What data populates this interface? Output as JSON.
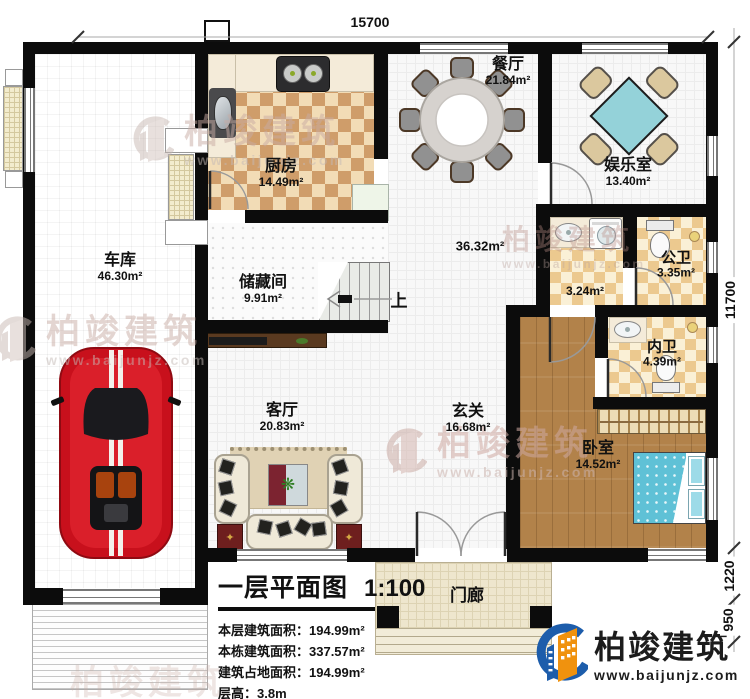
{
  "plan": {
    "dimensions": {
      "top": "15700",
      "right": [
        "11700",
        "1220",
        "950"
      ]
    },
    "stairs": {
      "up_label": "上"
    },
    "rooms": [
      {
        "name": "车库",
        "area": "46.30m²"
      },
      {
        "name": "厨房",
        "area": "14.49m²"
      },
      {
        "name": "餐厅",
        "area": "21.84m²"
      },
      {
        "name": "娱乐室",
        "area": "13.40m²"
      },
      {
        "name": "储藏间",
        "area": "9.91m²"
      },
      {
        "area": "36.32m²"
      },
      {
        "area": "3.24m²"
      },
      {
        "name": "公卫",
        "area": "3.35m²"
      },
      {
        "name": "内卫",
        "area": "4.39m²"
      },
      {
        "name": "玄关",
        "area": "16.68m²"
      },
      {
        "name": "卧室",
        "area": "14.52m²"
      },
      {
        "name": "客厅",
        "area": "20.83m²"
      },
      {
        "name": "门廊"
      }
    ],
    "title_block": {
      "title": "一层平面图",
      "scale": "1:100",
      "lines": [
        "本层建筑面积：194.99m²",
        "本栋建筑面积：337.57m²",
        "建筑占地面积：194.99m²",
        "层高：3.8m"
      ]
    },
    "branding": {
      "name": "柏竣建筑",
      "url": "www.baijunjz.com"
    },
    "icons": {
      "plant": "❋",
      "table_motif": "✦"
    }
  }
}
